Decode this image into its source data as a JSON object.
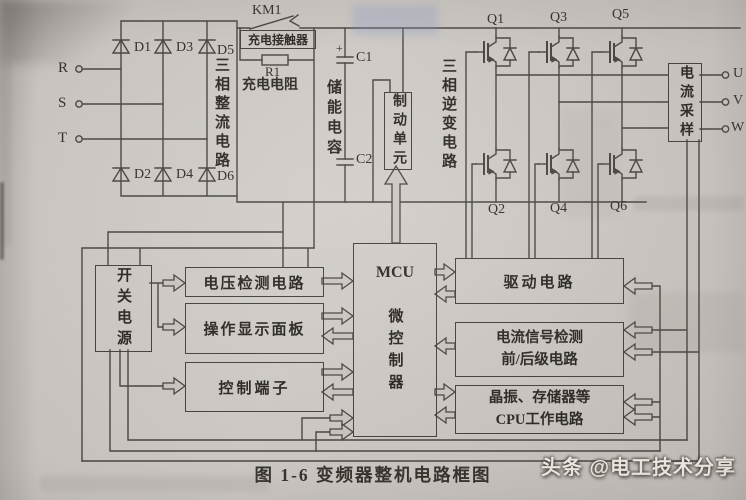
{
  "figure": {
    "caption": "图 1-6  变频器整机电路框图",
    "watermark": "头条 @电工技术分享"
  },
  "power_input": {
    "phase_r": "R",
    "phase_s": "S",
    "phase_t": "T"
  },
  "rectifier": {
    "label": "三相整流电路",
    "d1": "D1",
    "d2": "D2",
    "d3": "D3",
    "d4": "D4",
    "d5": "D5",
    "d6": "D6"
  },
  "charging": {
    "contactor_ref": "KM1",
    "contactor_name": "充电接触器",
    "resistor_ref": "R1",
    "resistor_name": "充电电阻"
  },
  "dc_link": {
    "label": "储能电容",
    "c1": "C1",
    "c1_polarity": "+",
    "c2": "C2",
    "c2_polarity": "+"
  },
  "braking": {
    "unit": "制动单元"
  },
  "inverter": {
    "label": "三相逆变电路",
    "q1": "Q1",
    "q2": "Q2",
    "q3": "Q3",
    "q4": "Q4",
    "q5": "Q5",
    "q6": "Q6"
  },
  "output": {
    "sampling": "电流采样",
    "phase_u": "U",
    "phase_v": "V",
    "phase_w": "W"
  },
  "control": {
    "smps": "开关电源",
    "voltage_detect": "电压检测电路",
    "display_panel": "操作显示面板",
    "control_terminals": "控制端子",
    "mcu_title": "MCU",
    "mcu_name": "微控制器",
    "drive": "驱动电路",
    "current_detect_line1": "电流信号检测",
    "current_detect_line2": "前/后级电路",
    "cpu_line1": "晶振、存储器等",
    "cpu_line2": "CPU工作电路"
  }
}
